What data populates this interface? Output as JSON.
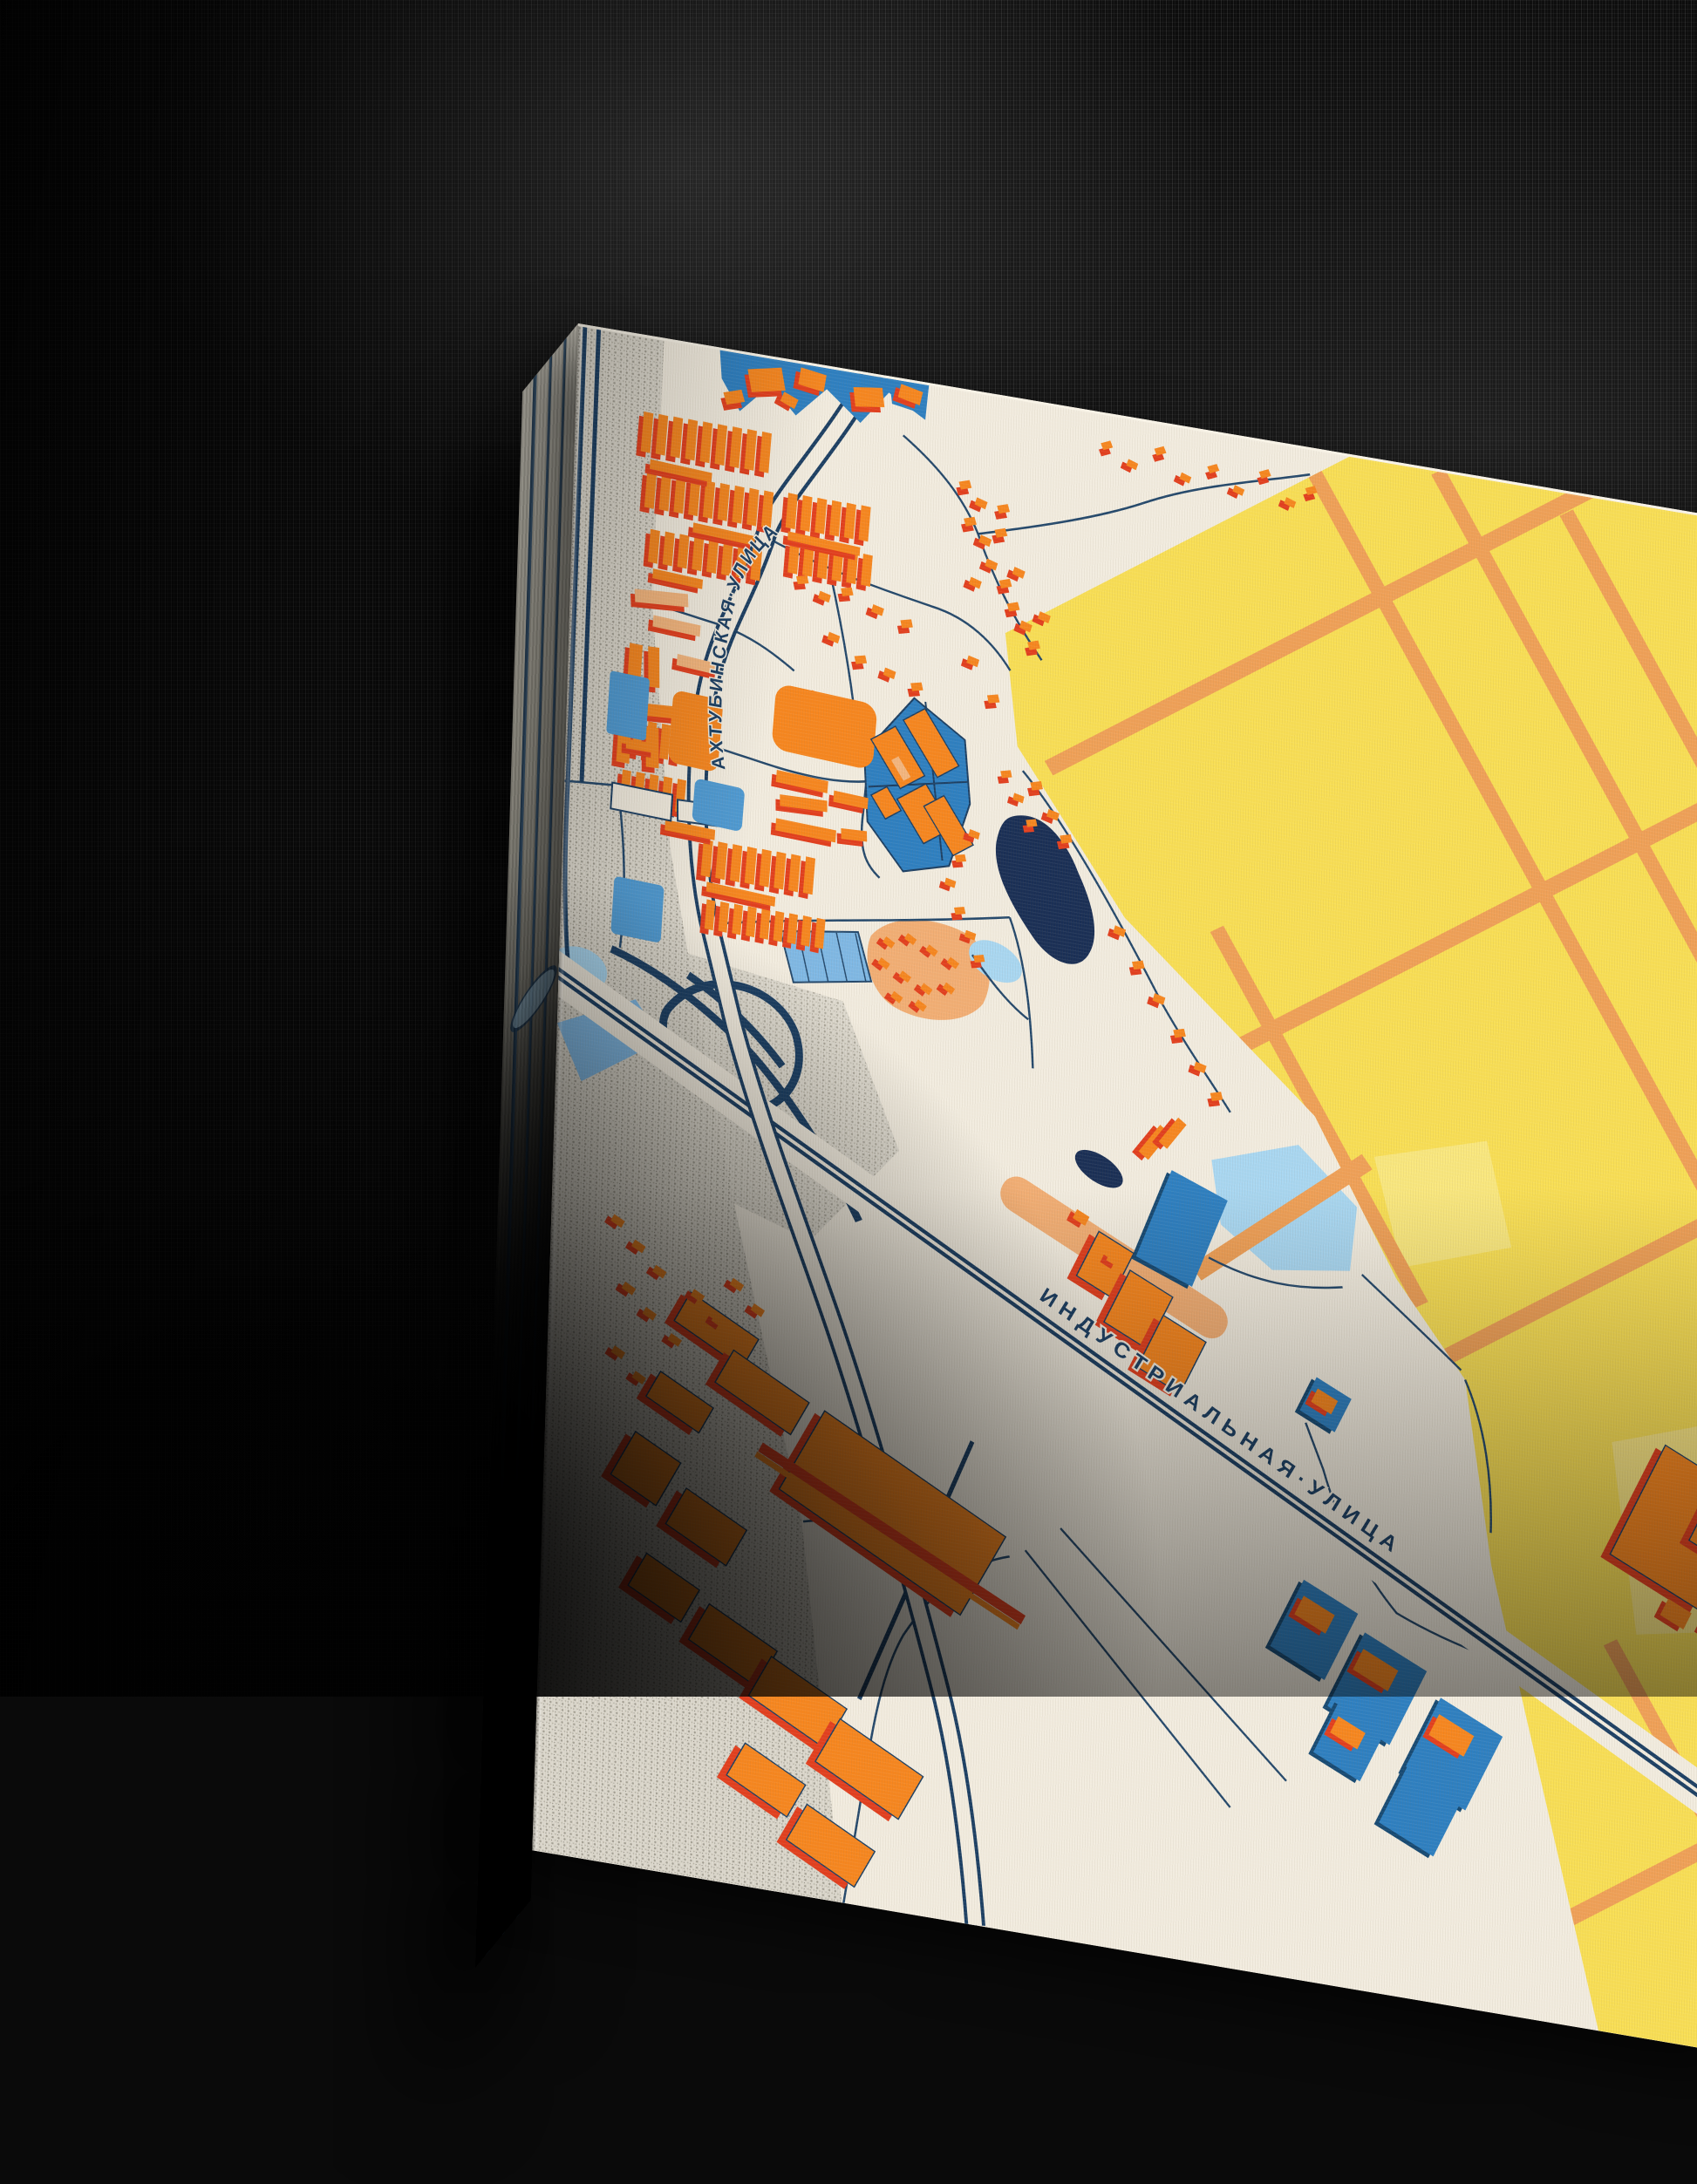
{
  "map": {
    "street_labels": [
      {
        "id": "akhtubinskaya",
        "label": "АХТУБИНСКАЯ·УЛИЦА"
      },
      {
        "id": "industrialnaya",
        "label": "ИНДУСТРИАЛЬНАЯ·УЛИЦА"
      }
    ],
    "palette": {
      "cream": "#f2ecdf",
      "navy": "#1c3f63",
      "building_orange": "#f6861f",
      "building_shadow_red": "#e23f1e",
      "building_peach": "#f3b57d",
      "building_blue": "#2e7fc0",
      "building_blue_shadow": "#174a73",
      "light_blue": "#7fb8e4",
      "pale_blue_water": "#a9d7f1",
      "dark_water_navy": "#1a2f55",
      "field_yellow": "#f8de55",
      "pale_yellow": "#fae683",
      "field_road_orange": "#efa057",
      "grey_halftone": "#c9c4b6",
      "wall_black": "#0a0a0a"
    }
  }
}
